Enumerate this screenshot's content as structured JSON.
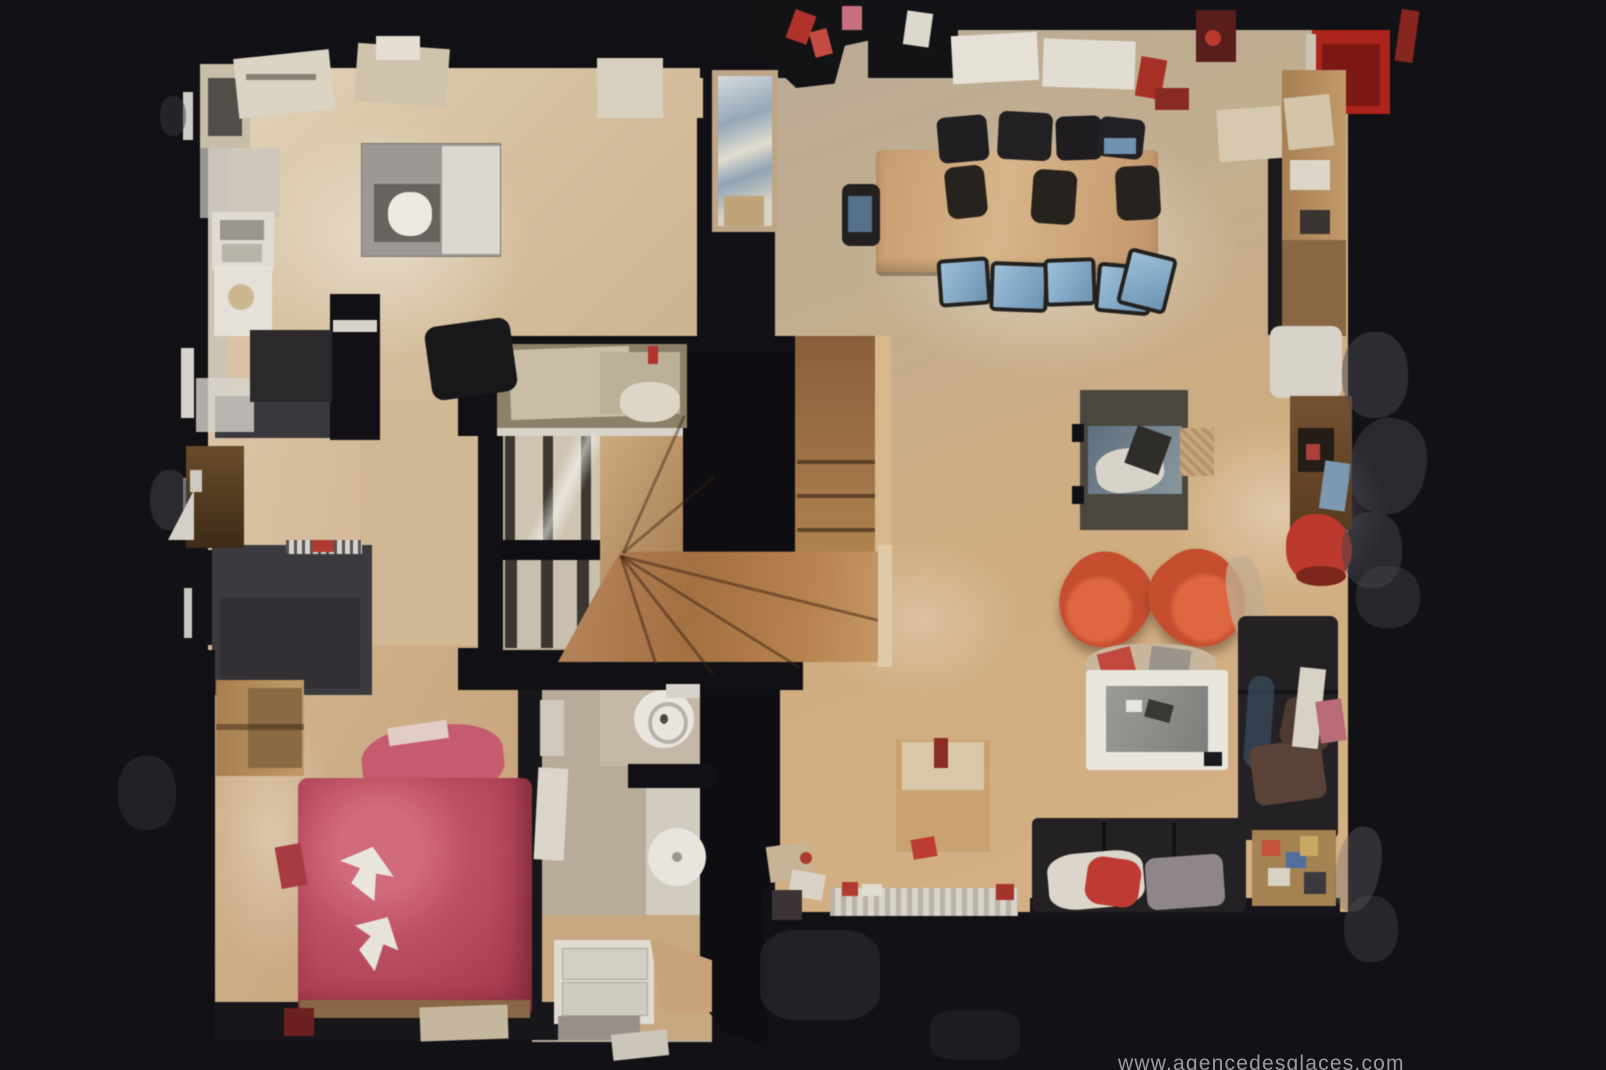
{
  "scene": {
    "type": "3d-dollhouse-floorplan-top-view",
    "watermark": "www.agencedesglaces.com"
  },
  "palette": {
    "bg": "#121116",
    "wall": "#111014",
    "floor_warm": "#d2ab7c",
    "floor_light": "#dcc6a6",
    "floor_gray": "#c0af99",
    "floor_bedroom": "#c9a87e",
    "floor_bathroom": "#b9ab99",
    "stair_wood": "#a97a4e",
    "bed_red": "#c14f63",
    "armchair_orange": "#cc4f30",
    "sofa_dark": "#242124",
    "table_wood": "#c79d6d",
    "chair_blue": "#7fa6c6",
    "accent_red": "#b5302a",
    "white_goods": "#e6e2d8",
    "fireplace_box": "#4a473f",
    "fireplace_glass": "#74838e",
    "closet_gray": "#3b3a3f",
    "cabinet_brown": "#6b4a2c",
    "watermark_text": "#9a9aa2"
  },
  "rooms": {
    "kitchen": {
      "objects": [
        "wall counters with sink",
        "cooktop",
        "kitchen island",
        "black cabinet",
        "office chair"
      ]
    },
    "dining_room": {
      "objects": [
        "long wood table",
        "blue upholstered chairs",
        "dark chairs",
        "white sideboard boxes",
        "red cabinet",
        "bar counter"
      ]
    },
    "living_room": {
      "objects": [
        "fireplace stove",
        "log basket",
        "orange tub armchair left",
        "orange tub armchair right",
        "white coffee table",
        "bottom leather sofa",
        "right sectional sofa",
        "red desk chair",
        "side table"
      ]
    },
    "stairwell": {
      "objects": [
        "winder staircase",
        "balustrade",
        "landing desk"
      ]
    },
    "bedroom": {
      "objects": [
        "double bed with red duvet",
        "white towels",
        "wardrobe",
        "gray closet"
      ]
    },
    "bathroom": {
      "objects": [
        "toilet",
        "round shower tray",
        "white vanity"
      ]
    },
    "hall": {
      "objects": [
        "console table",
        "radiator",
        "display cabinet"
      ]
    }
  }
}
